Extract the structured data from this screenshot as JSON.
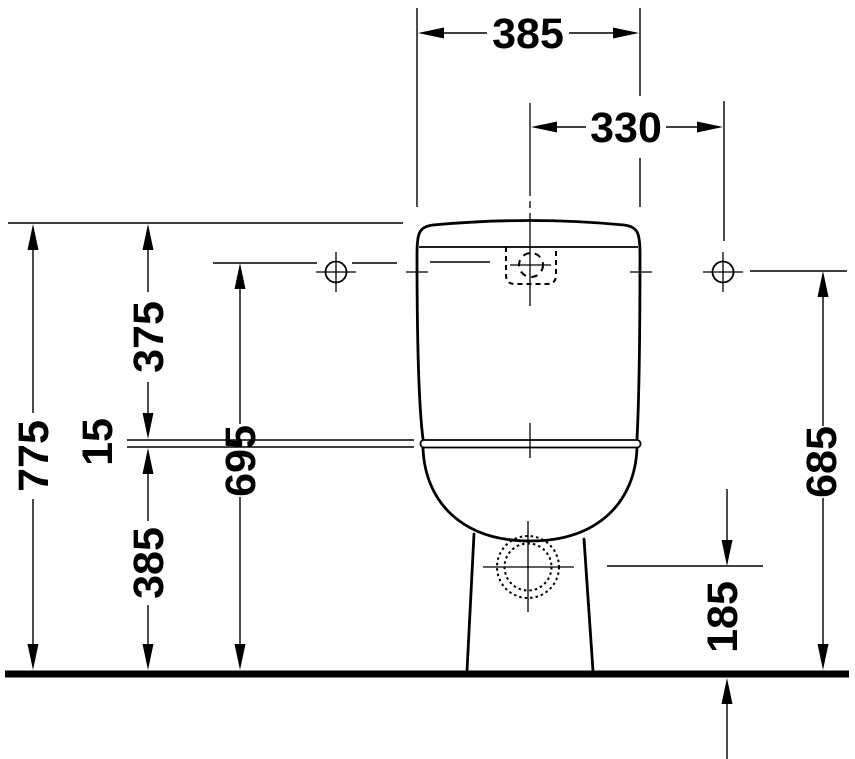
{
  "drawing": {
    "ink": "#000000",
    "background": "#ffffff",
    "dimensions": {
      "tank_width": "385",
      "flush_hole_spacing": "330",
      "overall_height": "775",
      "tank_top_to_seat": "375",
      "seat_joint_gap": "15",
      "flush_center_height": "695",
      "seat_height": "385",
      "fixing_hole_height": "685",
      "outlet_center_height": "185"
    }
  }
}
